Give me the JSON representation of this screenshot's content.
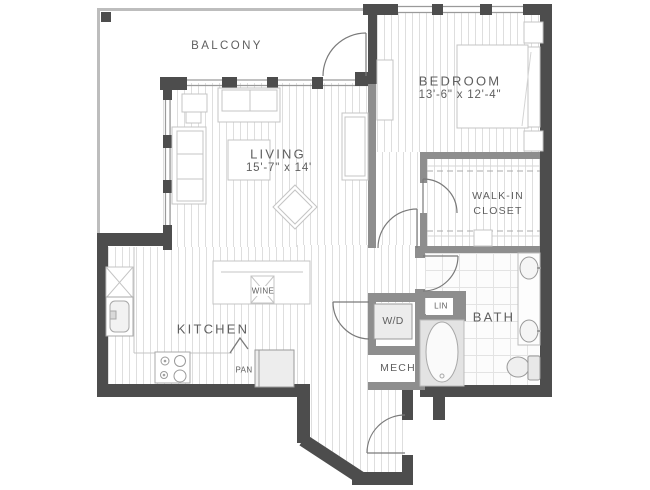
{
  "plan": {
    "type": "apartment-floor-plan",
    "rooms": {
      "balcony": {
        "label": "BALCONY"
      },
      "living": {
        "label": "LIVING",
        "dims": "15'-7\" x 14'"
      },
      "bedroom": {
        "label": "BEDROOM",
        "dims": "13'-6\" x 12'-4\""
      },
      "kitchen": {
        "label": "KITCHEN"
      },
      "walk_in_closet": {
        "label_line1": "WALK-IN",
        "label_line2": "CLOSET"
      },
      "bath": {
        "label": "BATH"
      },
      "laundry": {
        "label": "W/D"
      },
      "mech": {
        "label": "MECH"
      },
      "linen": {
        "label": "LIN"
      },
      "pantry": {
        "label": "PAN"
      },
      "wine": {
        "label": "WINE"
      }
    },
    "colors": {
      "exterior_wall": "#4d4d4d",
      "interior_wall": "#8e8e8e",
      "railing": "#bdbdbd",
      "floor_plank_line": "#dedede",
      "tile_line": "#e3e3e3",
      "furniture_outline": "#c4c4c4",
      "door_arc": "#7a7a7a",
      "label_text": "#5f5f5f"
    }
  }
}
